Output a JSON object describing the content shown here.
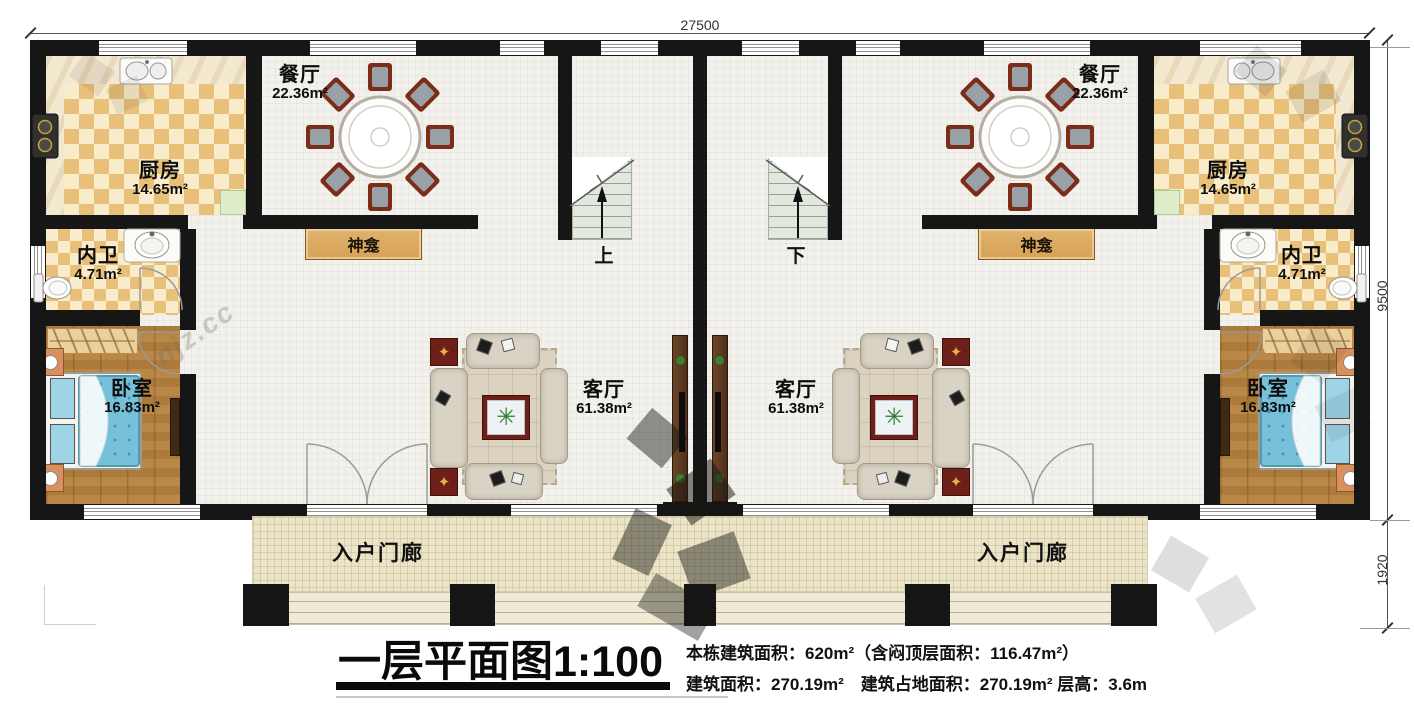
{
  "dimensions": {
    "top_width": "27500",
    "side_height": "9500",
    "porch_depth": "1920"
  },
  "units": [
    {
      "side": "left",
      "dining": {
        "name": "餐厅",
        "area": "22.36m²"
      },
      "kitchen": {
        "name": "厨房",
        "area": "14.65m²"
      },
      "bathroom": {
        "name": "内卫",
        "area": "4.71m²"
      },
      "bedroom": {
        "name": "卧室",
        "area": "16.83m²"
      },
      "living": {
        "name": "客厅",
        "area": "61.38m²"
      },
      "shrine": {
        "name": "神龛"
      },
      "porch": {
        "name": "入户门廊"
      },
      "stair": {
        "direction_label": "上"
      }
    },
    {
      "side": "right",
      "dining": {
        "name": "餐厅",
        "area": "22.36m²"
      },
      "kitchen": {
        "name": "厨房",
        "area": "14.65m²"
      },
      "bathroom": {
        "name": "内卫",
        "area": "4.71m²"
      },
      "bedroom": {
        "name": "卧室",
        "area": "16.83m²"
      },
      "living": {
        "name": "客厅",
        "area": "61.38m²"
      },
      "shrine": {
        "name": "神龛"
      },
      "porch": {
        "name": "入户门廊"
      },
      "stair": {
        "direction_label": "下"
      }
    }
  ],
  "title_block": {
    "title": "一层平面图1:100",
    "info_line1": "本栋建筑面积：620m²（含闷顶层面积：116.47m²）",
    "info_line2": "建筑面积：270.19m²　建筑占地面积：270.19m² 层高：3.6m"
  },
  "icons": {
    "plant": "✳",
    "lamp": "✦"
  },
  "colors": {
    "wall": "#161616",
    "floor": "#f2f1ec",
    "kitchen_a": "#e9c07a",
    "kitchen_b": "#f8ecca",
    "marble": "#f3e9d1",
    "wood": "#b5813e",
    "porch": "#ece4c7",
    "steps": "#f1ebd6",
    "stair": "#e3e8df",
    "shrine": "#d5a258",
    "bed": "#76c0da",
    "rug": "#dbd3bf",
    "sofa": "#d9d3c5",
    "maroon": "#6e2018",
    "dim_text": "#333333"
  }
}
